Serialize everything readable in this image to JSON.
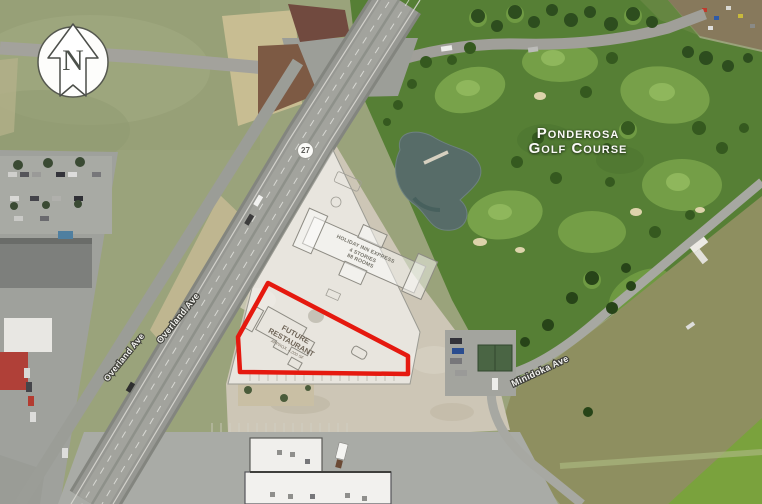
{
  "map": {
    "north_arrow": {
      "label": "N"
    },
    "highway_shield": {
      "number": "27"
    },
    "golf_course": {
      "name_line1": "Ponderosa",
      "name_line2": "Golf Course"
    },
    "site_plan": {
      "hotel": {
        "line1": "HOLIDAY INN EXPRESS",
        "line2": "4 STORIES",
        "line3": "88 ROOMS"
      },
      "restaurant": {
        "line1": "FUTURE",
        "line2": "RESTAURANT",
        "line3": "APPROX. 4,000 SF"
      },
      "parcel_outline_color": "#e5190f",
      "overlay_color": "#ffffff"
    },
    "road_labels": {
      "main": "Overland Ave",
      "frontage": "Overland Ave",
      "east": "Minidoka Ave"
    },
    "colors": {
      "farmland": "#9aa37b",
      "golf_green": "#567f35",
      "fairway": "#7ca64c",
      "pond": "#576c68",
      "dirt_lot": "#cdc6b6",
      "asphalt": "#979893",
      "parking": "#a9aba6",
      "red_outline": "#e5190f"
    }
  }
}
